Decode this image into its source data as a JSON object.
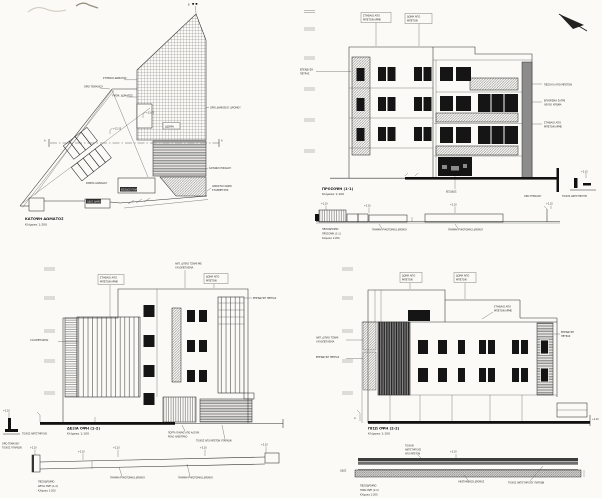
{
  "common": {
    "section_mark": "A",
    "north_mark": "B",
    "level_mark": "+2.10",
    "street_line_label": "ΓΡΑΜΜΗ ΡΥΜΟΤΟΜΙΑΣ ΔΡΟΜΟΥ"
  },
  "site_plan": {
    "title": "ΚΑΤΟΨΗ ΔΩΜΑΤΟΣ",
    "scale": "Κλίμακα 1:200",
    "roof_label": "ΔΩΜΑ",
    "roof_level": "+12.35",
    "stair_level": "+13.05",
    "labels": {
      "parapet": "ΣΤΗΘΑΙΟ ΔΩΜΑΤΟΣ",
      "roof_slab": "ΥΨΟΜ. ΔΩΜΑΤΟΣ",
      "plot_boundary": "ΟΡΙΟ ΤΕΜΑΧΙΟΥ",
      "road_boundary": "ΟΡΙΟ ΔΗΜΟΣΙΟΥ ΔΡΟΜΟΥ",
      "entrance_sill": "ΚΑΤΩΦΛΙ ΕΙΣΟΔΟΥ",
      "parking_line1": "ΑΝΟΙΚΤΟΙ ΧΩΡΟΙ",
      "parking_line2": "ΣΤΑΘΜΕΥΣΗΣ",
      "garage_entry": "ΕΙΣΟΔΟΣ ΓΚΑΡΑΖ",
      "street": "ΟΔΟΣ ΔΗΜΟΣΙΑ",
      "ramp": "ΡΑΜΠΑ ΚΑΘΟΔΟΥ"
    }
  },
  "front_elevation": {
    "title": "ΠΡΟΣΟΨΗ (1-1)",
    "scale": "Κλίμακα 1:100",
    "labels": {
      "parapet_line1": "ΣΤΗΘΑΙΟ ΑΠΟ",
      "parapet_line2": "ΜΠΕΤΟΝ ΑΡΜΕ",
      "roof_line1": "ΔΩΜΑ ΑΠΟ",
      "roof_line2": "ΜΠΕΤΟΝ",
      "stone_line1": "ΕΠΕΝΔΥΣΗ",
      "stone_line2": "ΠΕΤΡΑΣ",
      "ledge": "ΠΕΖΟΥΛΙ ΑΠΟ ΜΠΕΤΟΝ",
      "plaster_line1": "ΕΠΙΧΡΙΣΜΑ ΣΑΓΡΕ",
      "plaster_line2": "ΛΕΥΚΟ ΧΡΩΜΑ",
      "balcony_line1": "ΣΤΗΘΑΙΟ ΑΠΟ",
      "balcony_line2": "ΜΠΕΤΟΝ ΑΡΜΕ",
      "entrance": "ΕΙΣΟΔΟΣ",
      "plot_boundary": "ΟΡΙΟ ΤΕΜΑΧΙΟΥ",
      "retaining_wall": "ΤΟΙΧΟΣ ΑΝΤΙΣΤΗΡΙΞΗΣ"
    },
    "section": {
      "line1": "ΠΕΖΟΔΡΟΜΙΟ",
      "line2": "ΠΡΟΣΟΨΗ (1-1)",
      "line3": "Κλίμακα 1:200"
    }
  },
  "side_elevation": {
    "title": "ΔΕΞΙΑ ΟΨΗ (1-2)",
    "scale": "Κλίμακα 1:100",
    "labels": {
      "parapet_line1": "ΣΤΗΘΑΙΟ ΑΠΟ",
      "parapet_line2": "ΜΠΕΤΟΝ ΑΡΜΕ",
      "glass_line1": "ΑΝΤ. ΔΙΠΛΟ ΤΖΑΜΙ ΜΕ",
      "glass_line2": "ΥΑΛΟΠΕΤΑΣΜΑ",
      "roof_line1": "ΔΩΜΑ ΑΠΟ",
      "roof_line2": "ΜΠΕΤΟΝ",
      "stone": "ΕΠΕΝΔΥΣΗ ΠΕΤΡΑΣ",
      "curtain": "ΥΑΛΟΠΕΤΑΣΜΑ",
      "retaining_wall": "ΤΟΙΧΟΣ ΑΝΤΙΣΤΗΡΙΞΗΣ",
      "boundary_line1": "ΟΡΙΟ ΤΕΜΑΧΙΟΥ",
      "boundary_line2": "ΤΟΙΧΟΣ ΥΠΑΡΧΩΝ",
      "garage_line1": "ΠΟΡΤΑ ΓΚΑΡΑΖ ΑΠΟ ΑΛΟΥΜ.",
      "garage_line2": "ΡΟΛΟ ΗΛΕΚΤΡΙΚΟ",
      "wall_existing": "ΤΟΙΧΟΣ ΑΠΟ ΜΠΕΤΟΝ ΥΠΑΡΧΩΝ"
    },
    "section": {
      "line1": "ΠΕΖΟΔΡΟΜΙΟ",
      "line2": "ΔΕΞΙΑ ΟΨΗ (1-2)",
      "line3": "Κλίμακα 1:200"
    }
  },
  "rear_elevation": {
    "title": "ΠΙΣΩ ΟΨΗ (2-2)",
    "scale": "Κλίμακα 1:100",
    "labels": {
      "roof_a_line1": "ΔΩΜΑ ΑΠΟ",
      "roof_a_line2": "ΜΠΕΤΟΝ",
      "roof_b_line1": "ΔΩΜΑ ΑΠΟ",
      "roof_b_line2": "ΜΠΕΤΟΝ",
      "parapet_line1": "ΣΤΗΘΑΙΟ ΑΠΟ",
      "parapet_line2": "ΜΠΕΤΟΝ ΑΡΜΕ",
      "stone_right_line1": "ΕΠΕΝΔΥΣΗ",
      "stone_right_line2": "ΠΕΤΡΑΣ",
      "glass_line1": "ΑΝΤ. ΔΙΠΛΟ ΤΖΑΜΙ",
      "glass_line2": "ΥΑΛΟΠΕΤΑΣΜΑ",
      "stone_left": "ΕΠΕΝΔΥΣΗ ΠΕΤΡΑΣ",
      "road_existing": "ΥΦΙΣΤΑΜΕΝΟΣ ΔΡΟΜΟΣ",
      "ret_wall_existing": "ΤΟΙΧΟΣ ΑΝΤΙΣΤΗΡΙΞΗΣ ΥΠΑΡΧΩΝ",
      "small_wall_line1": "ΤΟΙΧΑΚΙ",
      "small_wall_line2": "ΑΝΤΙΣΤΗΡΙΞΗΣ",
      "small_wall_line3": "ΑΠΟ ΜΠΕΤΟΝ",
      "street": "ΟΔΟΣ"
    },
    "section": {
      "line1": "ΠΕΖΟΔΡΟΜΙΟ",
      "line2": "ΠΙΣΩ ΟΨΗ (2-2)",
      "line3": "Κλίμακα 1:200"
    }
  }
}
